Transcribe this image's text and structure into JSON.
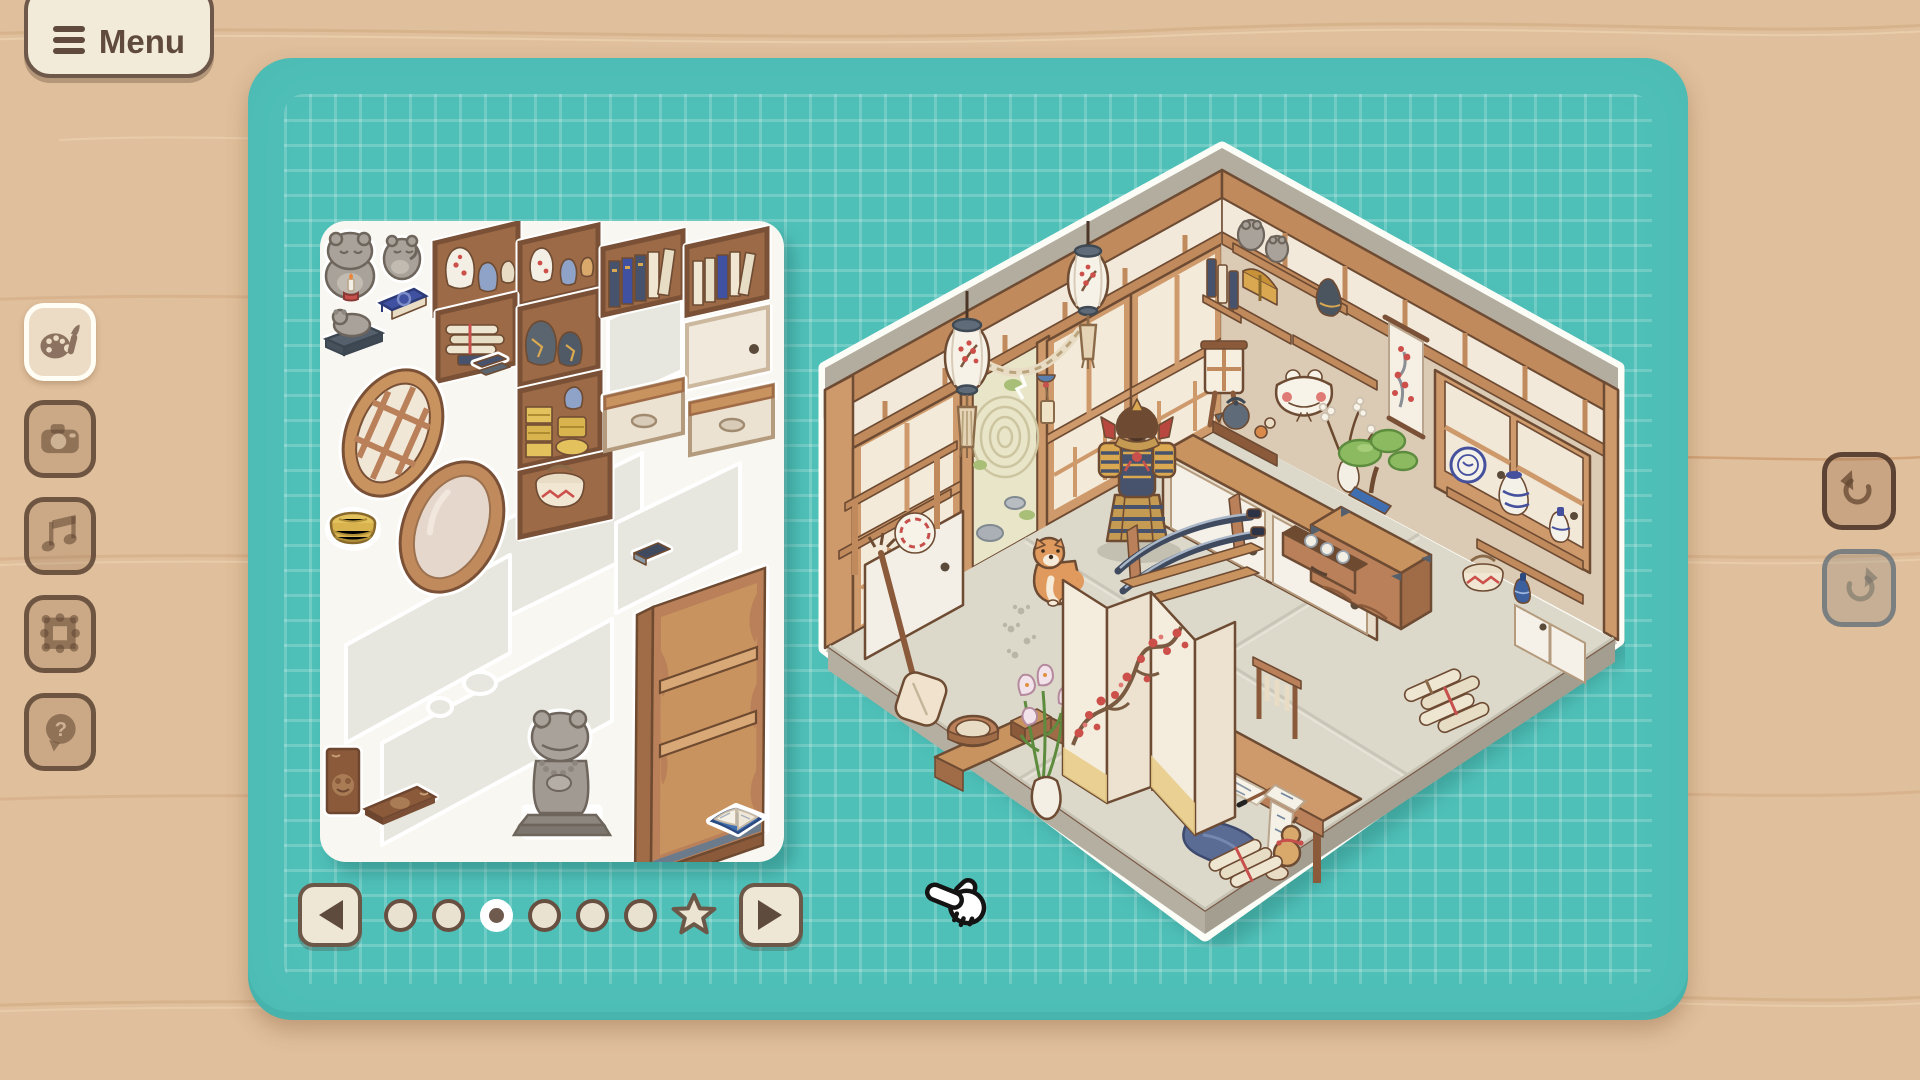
{
  "menu_button": {
    "label": "Menu",
    "icon": "hamburger-icon"
  },
  "sidebar": {
    "items": [
      {
        "id": "decorate",
        "icon": "palette-brush-icon",
        "state": "active"
      },
      {
        "id": "camera",
        "icon": "camera-icon",
        "state": "default"
      },
      {
        "id": "music",
        "icon": "music-note-icon",
        "state": "default"
      },
      {
        "id": "frames",
        "icon": "picture-frame-icon",
        "state": "default"
      },
      {
        "id": "help",
        "icon": "question-bubble-icon",
        "state": "default",
        "glyph": "?"
      }
    ]
  },
  "board": {
    "background_color": "#4fc0b8",
    "grid_color": "rgba(255,255,255,0.22)"
  },
  "tray": {
    "pagination": {
      "dots_total": 6,
      "active_index": 2,
      "star_page": true,
      "prev_icon": "left-arrow-icon",
      "next_icon": "right-arrow-icon",
      "star_icon": "star-icon"
    },
    "stickers": [
      "frog-candle-figurine",
      "small-frog-figurine",
      "blue-book",
      "stone-frog-statue",
      "round-lattice-window",
      "oval-mirror",
      "woven-basket",
      "shelf-vases",
      "shelf-vases-2",
      "shelf-scrolls",
      "shelf-kintsugi-jars",
      "shelf-gold-boxes",
      "shelf-basket",
      "shelf-books",
      "shelf-books-2",
      "sliding-door-panel",
      "drawer",
      "drawer-2",
      "small-books",
      "dark-book",
      "standing-frog-book",
      "flat-frog-book",
      "praying-frog-statue",
      "tall-bookshelf",
      "open-book"
    ]
  },
  "room": {
    "theme": "japanese-antique-room",
    "items": [
      "paper-lantern",
      "paper-lantern-2",
      "shimenawa-rope-chime",
      "shoji-doors",
      "zen-garden-doorway",
      "samurai-armor",
      "katana-rack",
      "shiba-inu",
      "paw-prints",
      "wall-shelves-frogs",
      "treasure-chest",
      "black-vase",
      "frog-mask",
      "hanging-scroll",
      "floor-lamp",
      "teapot-set",
      "flower-vase",
      "sideboard-cabinet",
      "tansu-chest",
      "open-drawer-teacups",
      "bonsai",
      "porcelain-shelf",
      "blue-white-jar",
      "blue-white-plate",
      "lidded-basket",
      "sake-bottle",
      "window-doors",
      "folding-screen",
      "bench-with-tub",
      "lily-vase",
      "shamisen",
      "wall-plate",
      "writing-desk",
      "scroll-rack",
      "draping-scroll",
      "blue-cloth",
      "gourd",
      "scroll-bundle",
      "floor-scrolls"
    ]
  },
  "history_controls": {
    "undo": {
      "icon": "undo-arrow-icon",
      "enabled": true
    },
    "redo": {
      "icon": "redo-arrow-icon",
      "enabled": false
    }
  },
  "cursor": {
    "icon": "hand-pointer-cursor"
  },
  "colors": {
    "background": "#e0bf9c",
    "board": "#4fc0b8",
    "cream": "#f2ebd9",
    "brown": "#6b5343"
  }
}
